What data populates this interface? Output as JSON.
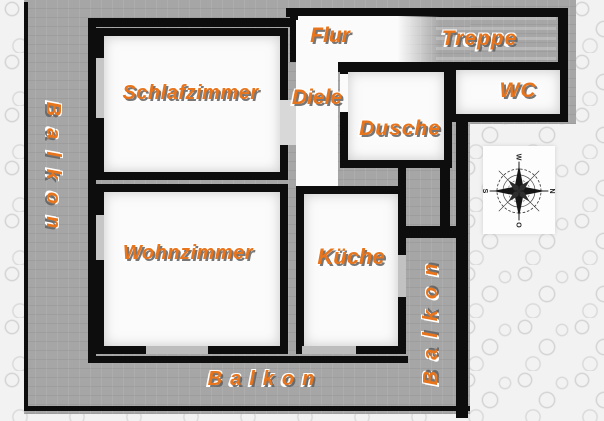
{
  "plan": {
    "title_hint": "apartment floor plan (scanned)",
    "labels": {
      "schlafzimmer": "Schlafzimmer",
      "wohnzimmer": "Wohnzimmer",
      "flur": "Flur",
      "treppe": "Treppe",
      "diele": "Diele",
      "dusche": "Dusche",
      "wc": "WC",
      "kueche": "Küche",
      "balkon_left": "Balkon",
      "balkon_bottom": "Balkon",
      "balkon_right": "Balkon"
    },
    "compass": {
      "n": "N",
      "e": "O",
      "s": "S",
      "w": "W",
      "north_points": "right"
    },
    "colors": {
      "label_orange": "#e8741c",
      "wall_black": "#0d0d0d",
      "plan_gray": "#a6a6a6",
      "room_white": "#fbfbfb",
      "outer_texture": "#f2f2f2"
    }
  }
}
